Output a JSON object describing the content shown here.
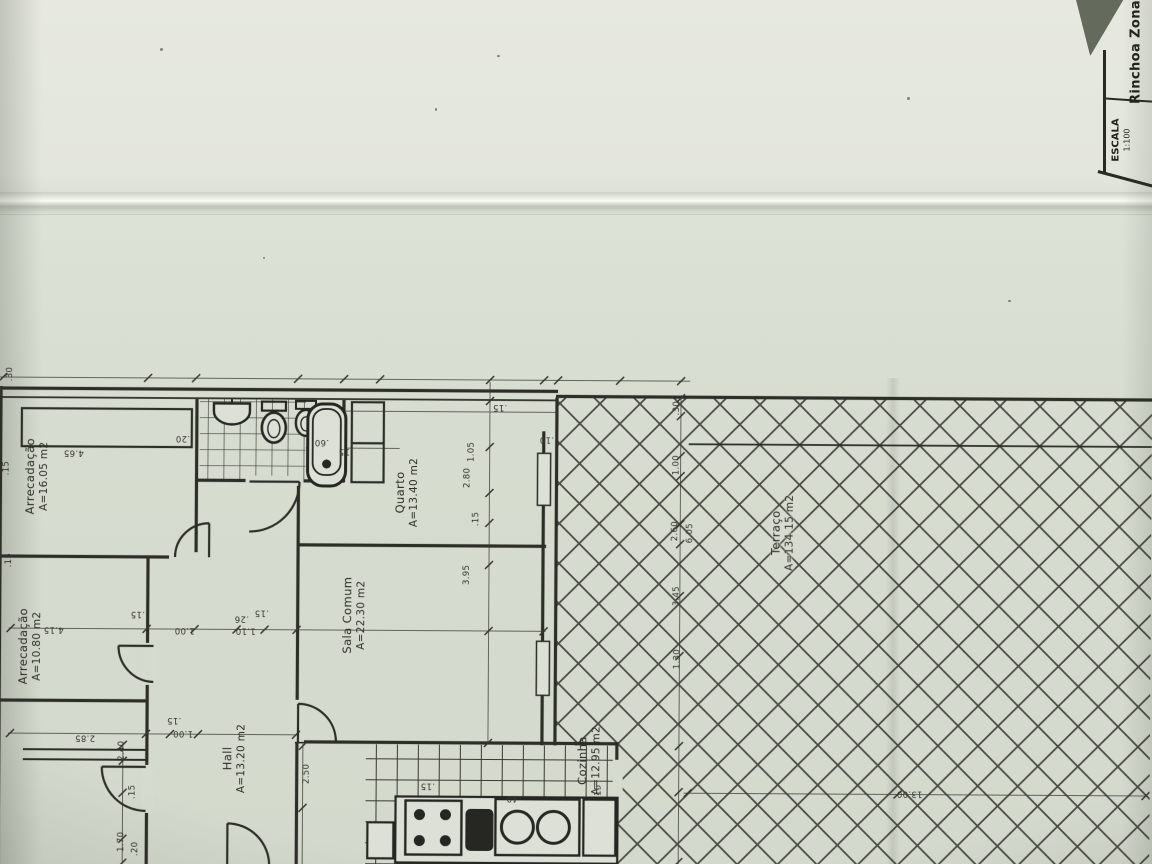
{
  "title_block": {
    "project": "Rinchoa Zona",
    "scale_label": "ESCALA",
    "scale_value": "1:100"
  },
  "rooms": [
    {
      "name": "Arrecadação",
      "area": "A=16.05 m2"
    },
    {
      "name": "Arrecadação",
      "area": "A=10.80 m2"
    },
    {
      "name": "Hall",
      "area": "A=13.20 m2"
    },
    {
      "name": "Sala Comum",
      "area": "A=22.30 m2"
    },
    {
      "name": "Quarto",
      "area": "A=13.40 m2"
    },
    {
      "name": "Cozinha",
      "area": "A=12.95 m2"
    },
    {
      "name": "Terraço",
      "area": "A=134.15 m2"
    }
  ],
  "dimensions": [
    {
      "text": ".30"
    },
    {
      "text": "4.65"
    },
    {
      "text": ".20"
    },
    {
      "text": ".60"
    },
    {
      "text": ".15"
    },
    {
      "text": ".15"
    },
    {
      "text": "1.05"
    },
    {
      "text": "2.80"
    },
    {
      "text": ".15"
    },
    {
      "text": "3.95"
    },
    {
      "text": ".15"
    },
    {
      "text": "1.00"
    },
    {
      "text": ".26"
    },
    {
      "text": ".15"
    },
    {
      "text": "1.10"
    },
    {
      "text": "4.15"
    },
    {
      "text": "2.85"
    },
    {
      "text": ".15"
    },
    {
      "text": "1.00"
    },
    {
      "text": "2.50"
    },
    {
      "text": "2.40"
    },
    {
      "text": ".15"
    },
    {
      "text": "1.70"
    },
    {
      "text": ".20"
    },
    {
      "text": "13.00"
    },
    {
      "text": ".30"
    },
    {
      "text": "1.00"
    },
    {
      "text": "2.60"
    },
    {
      "text": "6.05"
    },
    {
      "text": "3.45"
    },
    {
      "text": "1.30"
    },
    {
      "text": ".15"
    },
    {
      "text": ".40"
    },
    {
      "text": ".15"
    },
    {
      "text": ".10"
    },
    {
      "text": ".15"
    },
    {
      "text": ".15"
    }
  ],
  "colors": {
    "paper": "#d9ded3",
    "paper_light": "#e6e8e0",
    "ink": "#2b2b26"
  }
}
